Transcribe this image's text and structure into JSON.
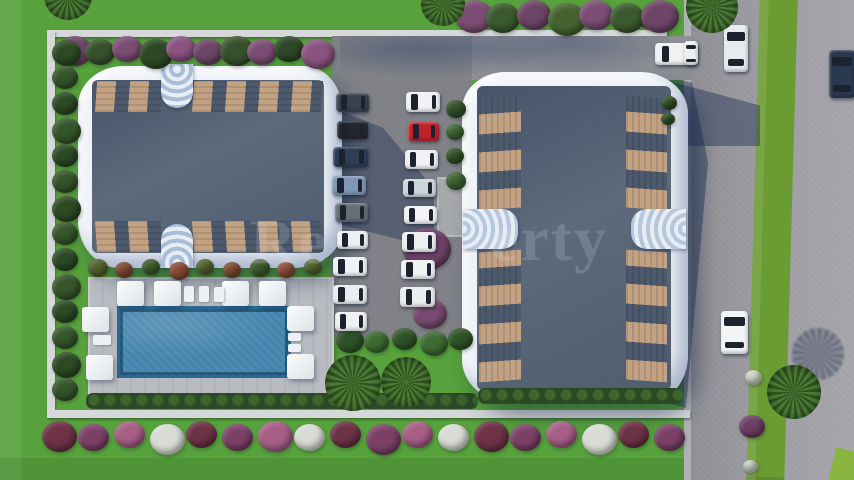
{
  "scene": {
    "label": "aerial-3d-render-residential-complex",
    "watermark": {
      "left_fragment": "Re",
      "right_fragment": "erty"
    }
  },
  "palette": {
    "lawn": "#57a23c",
    "median_green": "#6b9c33",
    "road": "#97979d",
    "asphalt": "#7e8086",
    "wall": "#d6d8da",
    "pool": "#4385ad",
    "pool_deck": "#b8bcc1",
    "roof": "#4e5c70",
    "building_rim": "#eef1f6",
    "balcony_wood": "#c3a183",
    "hedge": "#2b4a23",
    "purple_bush": "#6d4566",
    "red_car": "#c0212a",
    "shadow_blue": "rgba(24,40,78,0.42)"
  },
  "cars": [
    {
      "x": 336,
      "y": 93,
      "w": 33,
      "h": 19,
      "c": "#39414f",
      "o": "h"
    },
    {
      "x": 337,
      "y": 121,
      "w": 31,
      "h": 18,
      "c": "#23282f",
      "o": "h"
    },
    {
      "x": 333,
      "y": 147,
      "w": 35,
      "h": 20,
      "c": "#2e3d55",
      "o": "h"
    },
    {
      "x": 332,
      "y": 176,
      "w": 34,
      "h": 19,
      "c": "#7d98b5",
      "o": "h"
    },
    {
      "x": 335,
      "y": 203,
      "w": 33,
      "h": 19,
      "c": "#686e76",
      "o": "h"
    },
    {
      "x": 337,
      "y": 231,
      "w": 31,
      "h": 18,
      "c": "#edeff1",
      "o": "h"
    },
    {
      "x": 333,
      "y": 257,
      "w": 34,
      "h": 19,
      "c": "#f2f3f5",
      "o": "h"
    },
    {
      "x": 333,
      "y": 285,
      "w": 34,
      "h": 19,
      "c": "#ebedf0",
      "o": "h"
    },
    {
      "x": 335,
      "y": 312,
      "w": 32,
      "h": 19,
      "c": "#f0f1f3",
      "o": "h"
    },
    {
      "x": 406,
      "y": 92,
      "w": 34,
      "h": 20,
      "c": "#f1f2f4",
      "o": "h"
    },
    {
      "x": 408,
      "y": 122,
      "w": 31,
      "h": 19,
      "c": "#c0212a",
      "o": "h"
    },
    {
      "x": 405,
      "y": 150,
      "w": 33,
      "h": 19,
      "c": "#eff1f3",
      "o": "h"
    },
    {
      "x": 403,
      "y": 179,
      "w": 33,
      "h": 18,
      "c": "#ccd6da",
      "o": "h"
    },
    {
      "x": 404,
      "y": 206,
      "w": 33,
      "h": 18,
      "c": "#f2f3f5",
      "o": "h"
    },
    {
      "x": 402,
      "y": 232,
      "w": 34,
      "h": 20,
      "c": "#edeff1",
      "o": "h"
    },
    {
      "x": 401,
      "y": 260,
      "w": 34,
      "h": 19,
      "c": "#f1f2f4",
      "o": "h"
    },
    {
      "x": 400,
      "y": 287,
      "w": 35,
      "h": 20,
      "c": "#ebedf0",
      "o": "h"
    },
    {
      "x": 655,
      "y": 43,
      "w": 42,
      "h": 22,
      "c": "#eff1f3",
      "o": "h"
    },
    {
      "x": 724,
      "y": 25,
      "w": 24,
      "h": 47,
      "c": "#e8ebee",
      "o": "v"
    },
    {
      "x": 829,
      "y": 50,
      "w": 26,
      "h": 48,
      "c": "#2a3850",
      "o": "v"
    },
    {
      "x": 721,
      "y": 311,
      "w": 27,
      "h": 43,
      "c": "#f2f4f6",
      "o": "v"
    },
    {
      "x": 684,
      "y": 41,
      "w": 14,
      "h": 24,
      "c": "#eef0f2",
      "o": "v"
    }
  ],
  "umbrellas": [
    {
      "x": 117,
      "y": 281
    },
    {
      "x": 154,
      "y": 281
    },
    {
      "x": 222,
      "y": 281
    },
    {
      "x": 259,
      "y": 281
    },
    {
      "x": 82,
      "y": 307
    },
    {
      "x": 287,
      "y": 306
    },
    {
      "x": 86,
      "y": 355
    },
    {
      "x": 287,
      "y": 354
    }
  ],
  "loungers": [
    {
      "x": 184,
      "y": 286,
      "w": 10,
      "h": 16
    },
    {
      "x": 199,
      "y": 286,
      "w": 10,
      "h": 16
    },
    {
      "x": 214,
      "y": 287,
      "w": 10,
      "h": 15
    },
    {
      "x": 93,
      "y": 335,
      "w": 18,
      "h": 10
    },
    {
      "x": 288,
      "y": 333,
      "w": 13,
      "h": 8
    },
    {
      "x": 288,
      "y": 344,
      "w": 13,
      "h": 8
    }
  ],
  "palms": [
    {
      "cx": 353,
      "cy": 383,
      "r": 28,
      "rot": 10
    },
    {
      "cx": 406,
      "cy": 382,
      "r": 25,
      "rot": 40
    },
    {
      "cx": 68,
      "cy": -4,
      "r": 24,
      "rot": 0
    },
    {
      "cx": 443,
      "cy": 4,
      "r": 22,
      "rot": 20
    },
    {
      "cx": 712,
      "cy": 7,
      "r": 26,
      "rot": 55
    },
    {
      "cx": 794,
      "cy": 392,
      "r": 27,
      "rot": 0
    }
  ],
  "palm_shadows": [
    {
      "cx": 818,
      "cy": 354,
      "r": 26
    }
  ],
  "single_bushes": [
    {
      "x": 403,
      "y": 228,
      "s": 48,
      "c": "#6d4166"
    },
    {
      "x": 413,
      "y": 299,
      "s": 34,
      "c": "#7a4a70"
    },
    {
      "x": 745,
      "y": 370,
      "s": 17,
      "c": "#cfd6c8"
    },
    {
      "x": 739,
      "y": 415,
      "s": 26,
      "c": "#6d3f66"
    },
    {
      "x": 743,
      "y": 460,
      "s": 15,
      "c": "#c9d2c4"
    },
    {
      "x": 638,
      "y": 8,
      "s": 24,
      "c": "#8a3d50"
    }
  ],
  "bush_rows": [
    {
      "name": "top-inside-purple",
      "x": 58,
      "y": 36,
      "dx": 27,
      "dy": 0,
      "count": 10,
      "size": 30,
      "colors": [
        "#6d4566",
        "#37512c",
        "#7c4d74",
        "#2e4726",
        "#8a5380"
      ]
    },
    {
      "name": "top-outer",
      "x": 455,
      "y": 0,
      "dx": 31,
      "dy": 0,
      "count": 7,
      "size": 34,
      "colors": [
        "#7c4d74",
        "#3a5a2e",
        "#6d4566",
        "#45632f"
      ]
    },
    {
      "name": "left-hedge-column",
      "x": 52,
      "y": 40,
      "dx": 0,
      "dy": 26,
      "count": 14,
      "size": 26,
      "colors": [
        "#2c4a24",
        "#35562a"
      ]
    },
    {
      "name": "south-garden-strip",
      "x": 88,
      "y": 259,
      "dx": 27,
      "dy": 0,
      "count": 9,
      "size": 18,
      "colors": [
        "#50632f",
        "#7c4a2e",
        "#3c5a2c",
        "#8a4a38"
      ]
    },
    {
      "name": "flower-row-bottom",
      "x": 42,
      "y": 421,
      "dx": 36,
      "dy": 0,
      "count": 18,
      "size": 31,
      "colors": [
        "#6d3246",
        "#7c4067",
        "#a75f86",
        "#d9dcd4"
      ]
    },
    {
      "name": "bottom-mid-trees",
      "x": 336,
      "y": 328,
      "dx": 28,
      "dy": 0,
      "count": 5,
      "size": 25,
      "colors": [
        "#2f5428",
        "#3d6b32"
      ]
    },
    {
      "name": "parking-right-greens",
      "x": 446,
      "y": 100,
      "dx": 0,
      "dy": 24,
      "count": 4,
      "size": 18,
      "colors": [
        "#2e5026",
        "#3b6331"
      ]
    },
    {
      "name": "building-topright",
      "x": 661,
      "y": 96,
      "dx": 0,
      "dy": 17,
      "count": 2,
      "size": 14,
      "colors": [
        "#2e5026"
      ]
    }
  ]
}
